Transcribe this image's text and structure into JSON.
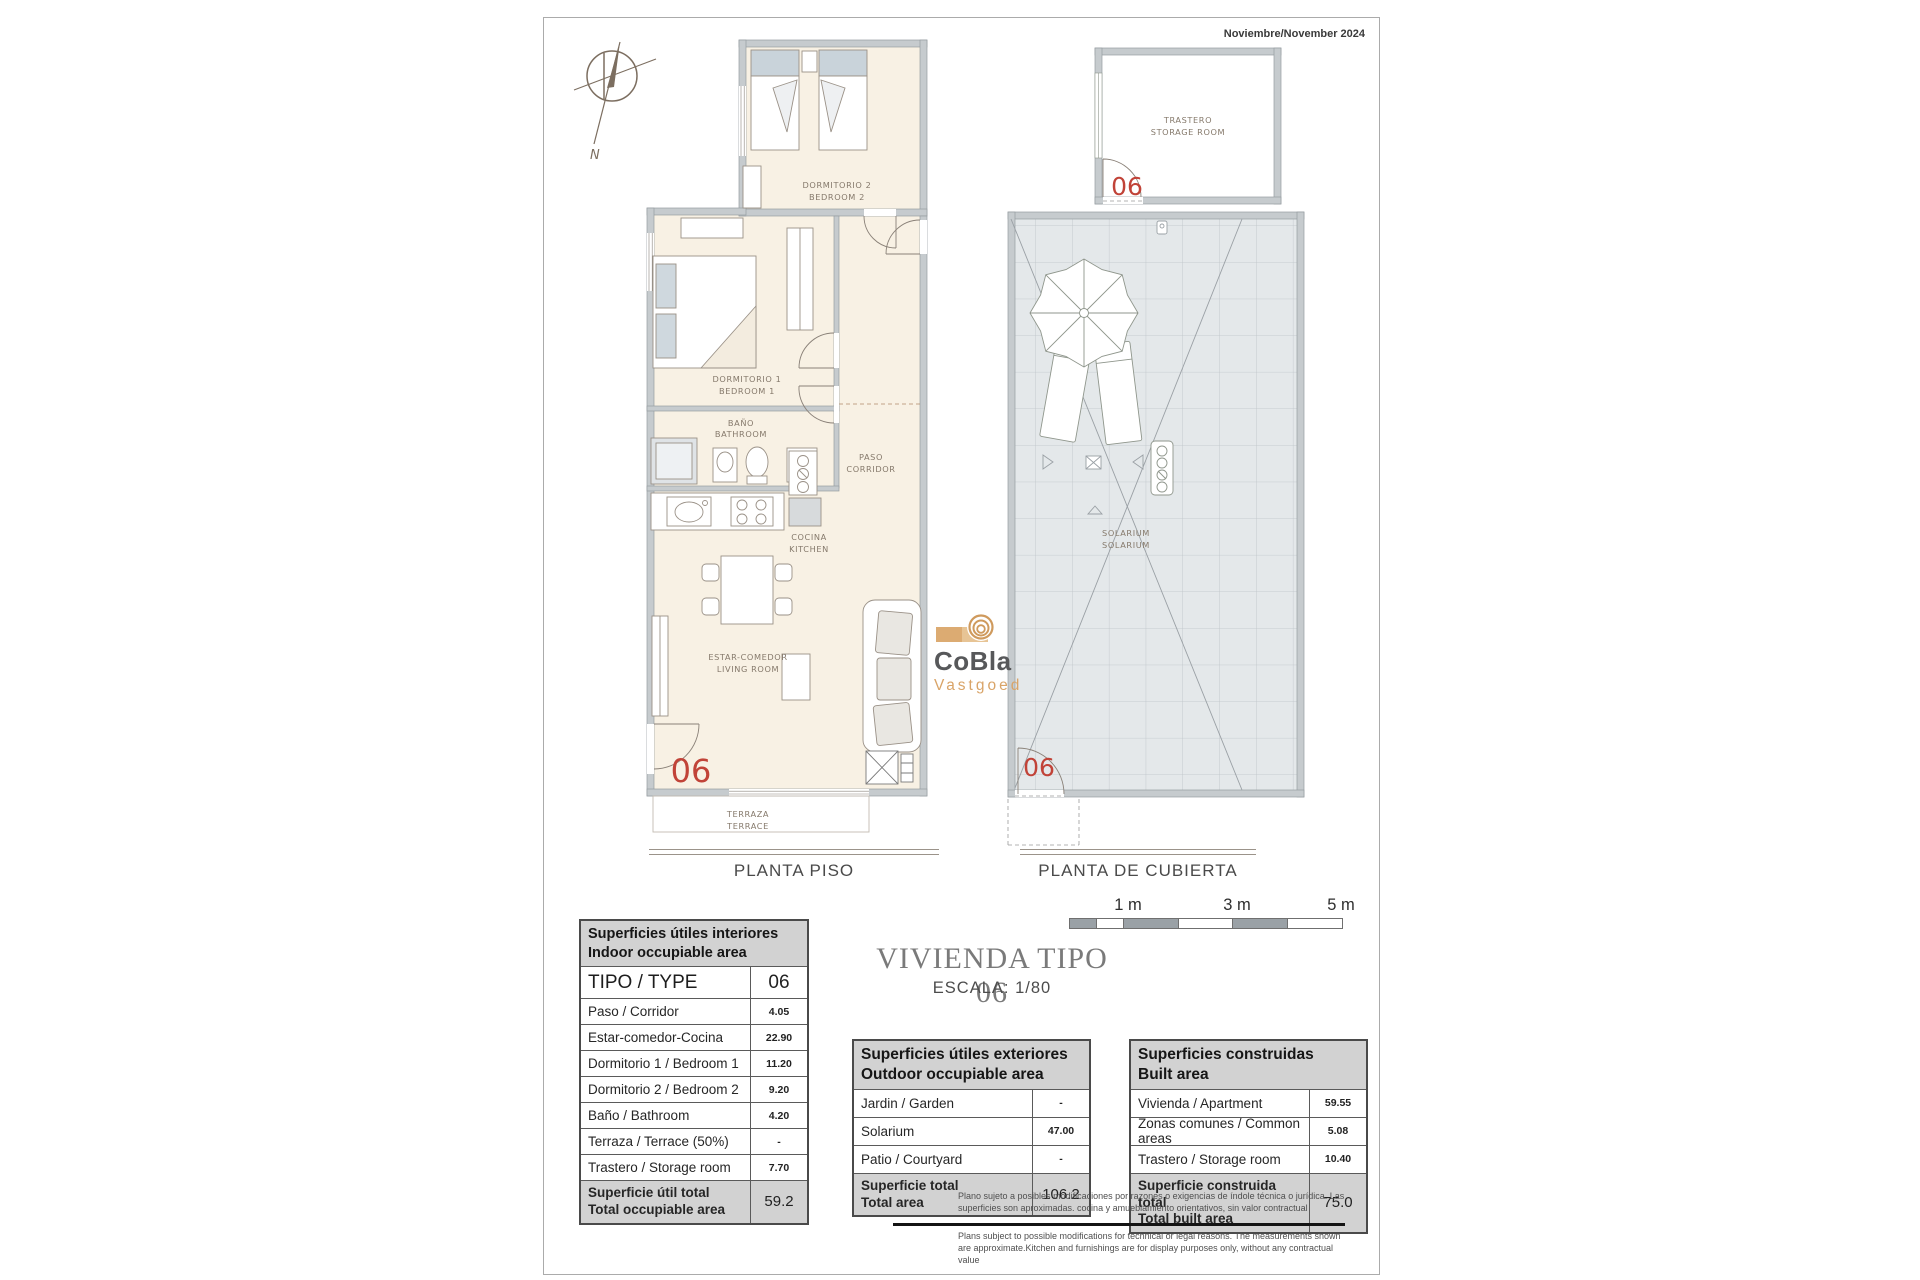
{
  "meta": {
    "date": "Noviembre/November 2024"
  },
  "compass": {
    "north_label": "N"
  },
  "logo": {
    "name": "CoBla",
    "sub": "Vastgoed"
  },
  "title": {
    "main": "VIVIENDA TIPO 06",
    "scale": "ESCALA: 1/80"
  },
  "scale_bar": {
    "labels": [
      "1 m",
      "3 m",
      "5 m"
    ]
  },
  "plans": {
    "floor": {
      "label": "PLANTA PISO",
      "unit_number": "06",
      "rooms": {
        "bedroom2": [
          "DORMITORIO 2",
          "BEDROOM 2"
        ],
        "bedroom1": [
          "DORMITORIO 1",
          "BEDROOM 1"
        ],
        "bathroom": [
          "BAÑO",
          "BATHROOM"
        ],
        "corridor": [
          "PASO",
          "CORRIDOR"
        ],
        "kitchen": [
          "COCINA",
          "KITCHEN"
        ],
        "living": [
          "ESTAR-COMEDOR",
          "LIVING ROOM"
        ],
        "terrace": [
          "TERRAZA",
          "TERRACE"
        ]
      }
    },
    "roof": {
      "label": "PLANTA DE CUBIERTA",
      "unit_number": "06",
      "rooms": {
        "storage": [
          "TRASTERO",
          "STORAGE ROOM"
        ],
        "solarium": [
          "SOLARIUM",
          "SOLARIUM"
        ]
      }
    }
  },
  "tables": {
    "interior": {
      "header": [
        "Superficies útiles interiores",
        "Indoor occupiable area"
      ],
      "type_row": {
        "label": "TIPO / TYPE",
        "value": "06"
      },
      "rows": [
        {
          "label": "Paso / Corridor",
          "value": "4.05"
        },
        {
          "label": "Estar-comedor-Cocina",
          "value": "22.90"
        },
        {
          "label": "Dormitorio 1 / Bedroom 1",
          "value": "11.20"
        },
        {
          "label": "Dormitorio 2 / Bedroom 2",
          "value": "9.20"
        },
        {
          "label": "Baño / Bathroom",
          "value": "4.20"
        },
        {
          "label": "Terraza / Terrace (50%)",
          "value": "-"
        },
        {
          "label": "Trastero / Storage room",
          "value": "7.70"
        }
      ],
      "total": {
        "label": [
          "Superficie útil total",
          "Total occupiable area"
        ],
        "value": "59.2"
      }
    },
    "exterior": {
      "header": [
        "Superficies útiles exteriores",
        "Outdoor occupiable area"
      ],
      "rows": [
        {
          "label": "Jardin / Garden",
          "value": "-"
        },
        {
          "label": "Solarium",
          "value": "47.00"
        },
        {
          "label": "Patio / Courtyard",
          "value": "-"
        }
      ],
      "total": {
        "label": [
          "Superficie total",
          "Total area"
        ],
        "value": "106.2"
      }
    },
    "built": {
      "header": [
        "Superficies construidas",
        "Built area"
      ],
      "rows": [
        {
          "label": "Vivienda / Apartment",
          "value": "59.55"
        },
        {
          "label": "Zonas comunes / Common areas",
          "value": "5.08"
        },
        {
          "label": "Trastero / Storage room",
          "value": "10.40"
        }
      ],
      "total": {
        "label": [
          "Superficie construida total",
          "Total built area"
        ],
        "value": "75.0"
      }
    }
  },
  "disclaimer": {
    "es": "Plano sujeto a posibles modificaciones por razones o exigencias de índole técnica o jurídica. Las superficies son aproximadas. cocina y amueblamiento  orientativos, sin valor contractual",
    "en": "Plans subject to possible modifications for technical or legal reasons. The measurements shown are approximate.Kitchen and furnishings are for display purposes only, without any contractual value"
  },
  "colors": {
    "accent_red": "#c14338",
    "logo_tan": "#d9a468",
    "wall_gray": "#c6cbce",
    "floor_cream": "#f8f1e4",
    "tile_gray": "#e4e8ea"
  }
}
